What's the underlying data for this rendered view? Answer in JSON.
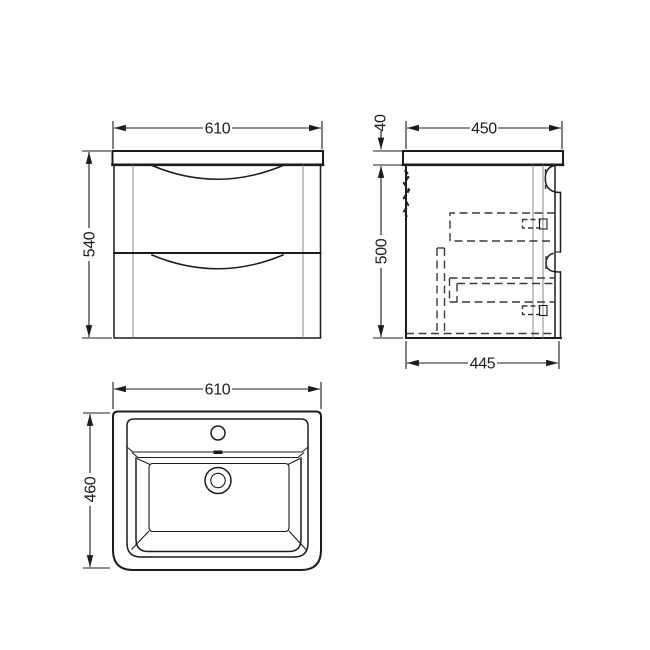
{
  "drawing": {
    "type": "technical-dimension-drawing",
    "subject": "wall-hung vanity unit with basin, three orthographic views",
    "colors": {
      "background": "#ffffff",
      "solid_line": "#1c1c1c",
      "hidden_line": "#3a3a3a",
      "panel_line": "#8a8a8a"
    },
    "views": {
      "front": {
        "name": "front elevation",
        "width_mm": "610",
        "height_mm": "540"
      },
      "side": {
        "name": "side section",
        "top_depth_mm": "450",
        "worktop_thickness_mm": "40",
        "cabinet_height_mm": "500",
        "bottom_depth_mm": "445"
      },
      "basin": {
        "name": "basin plan",
        "width_mm": "610",
        "depth_mm": "460"
      }
    }
  }
}
